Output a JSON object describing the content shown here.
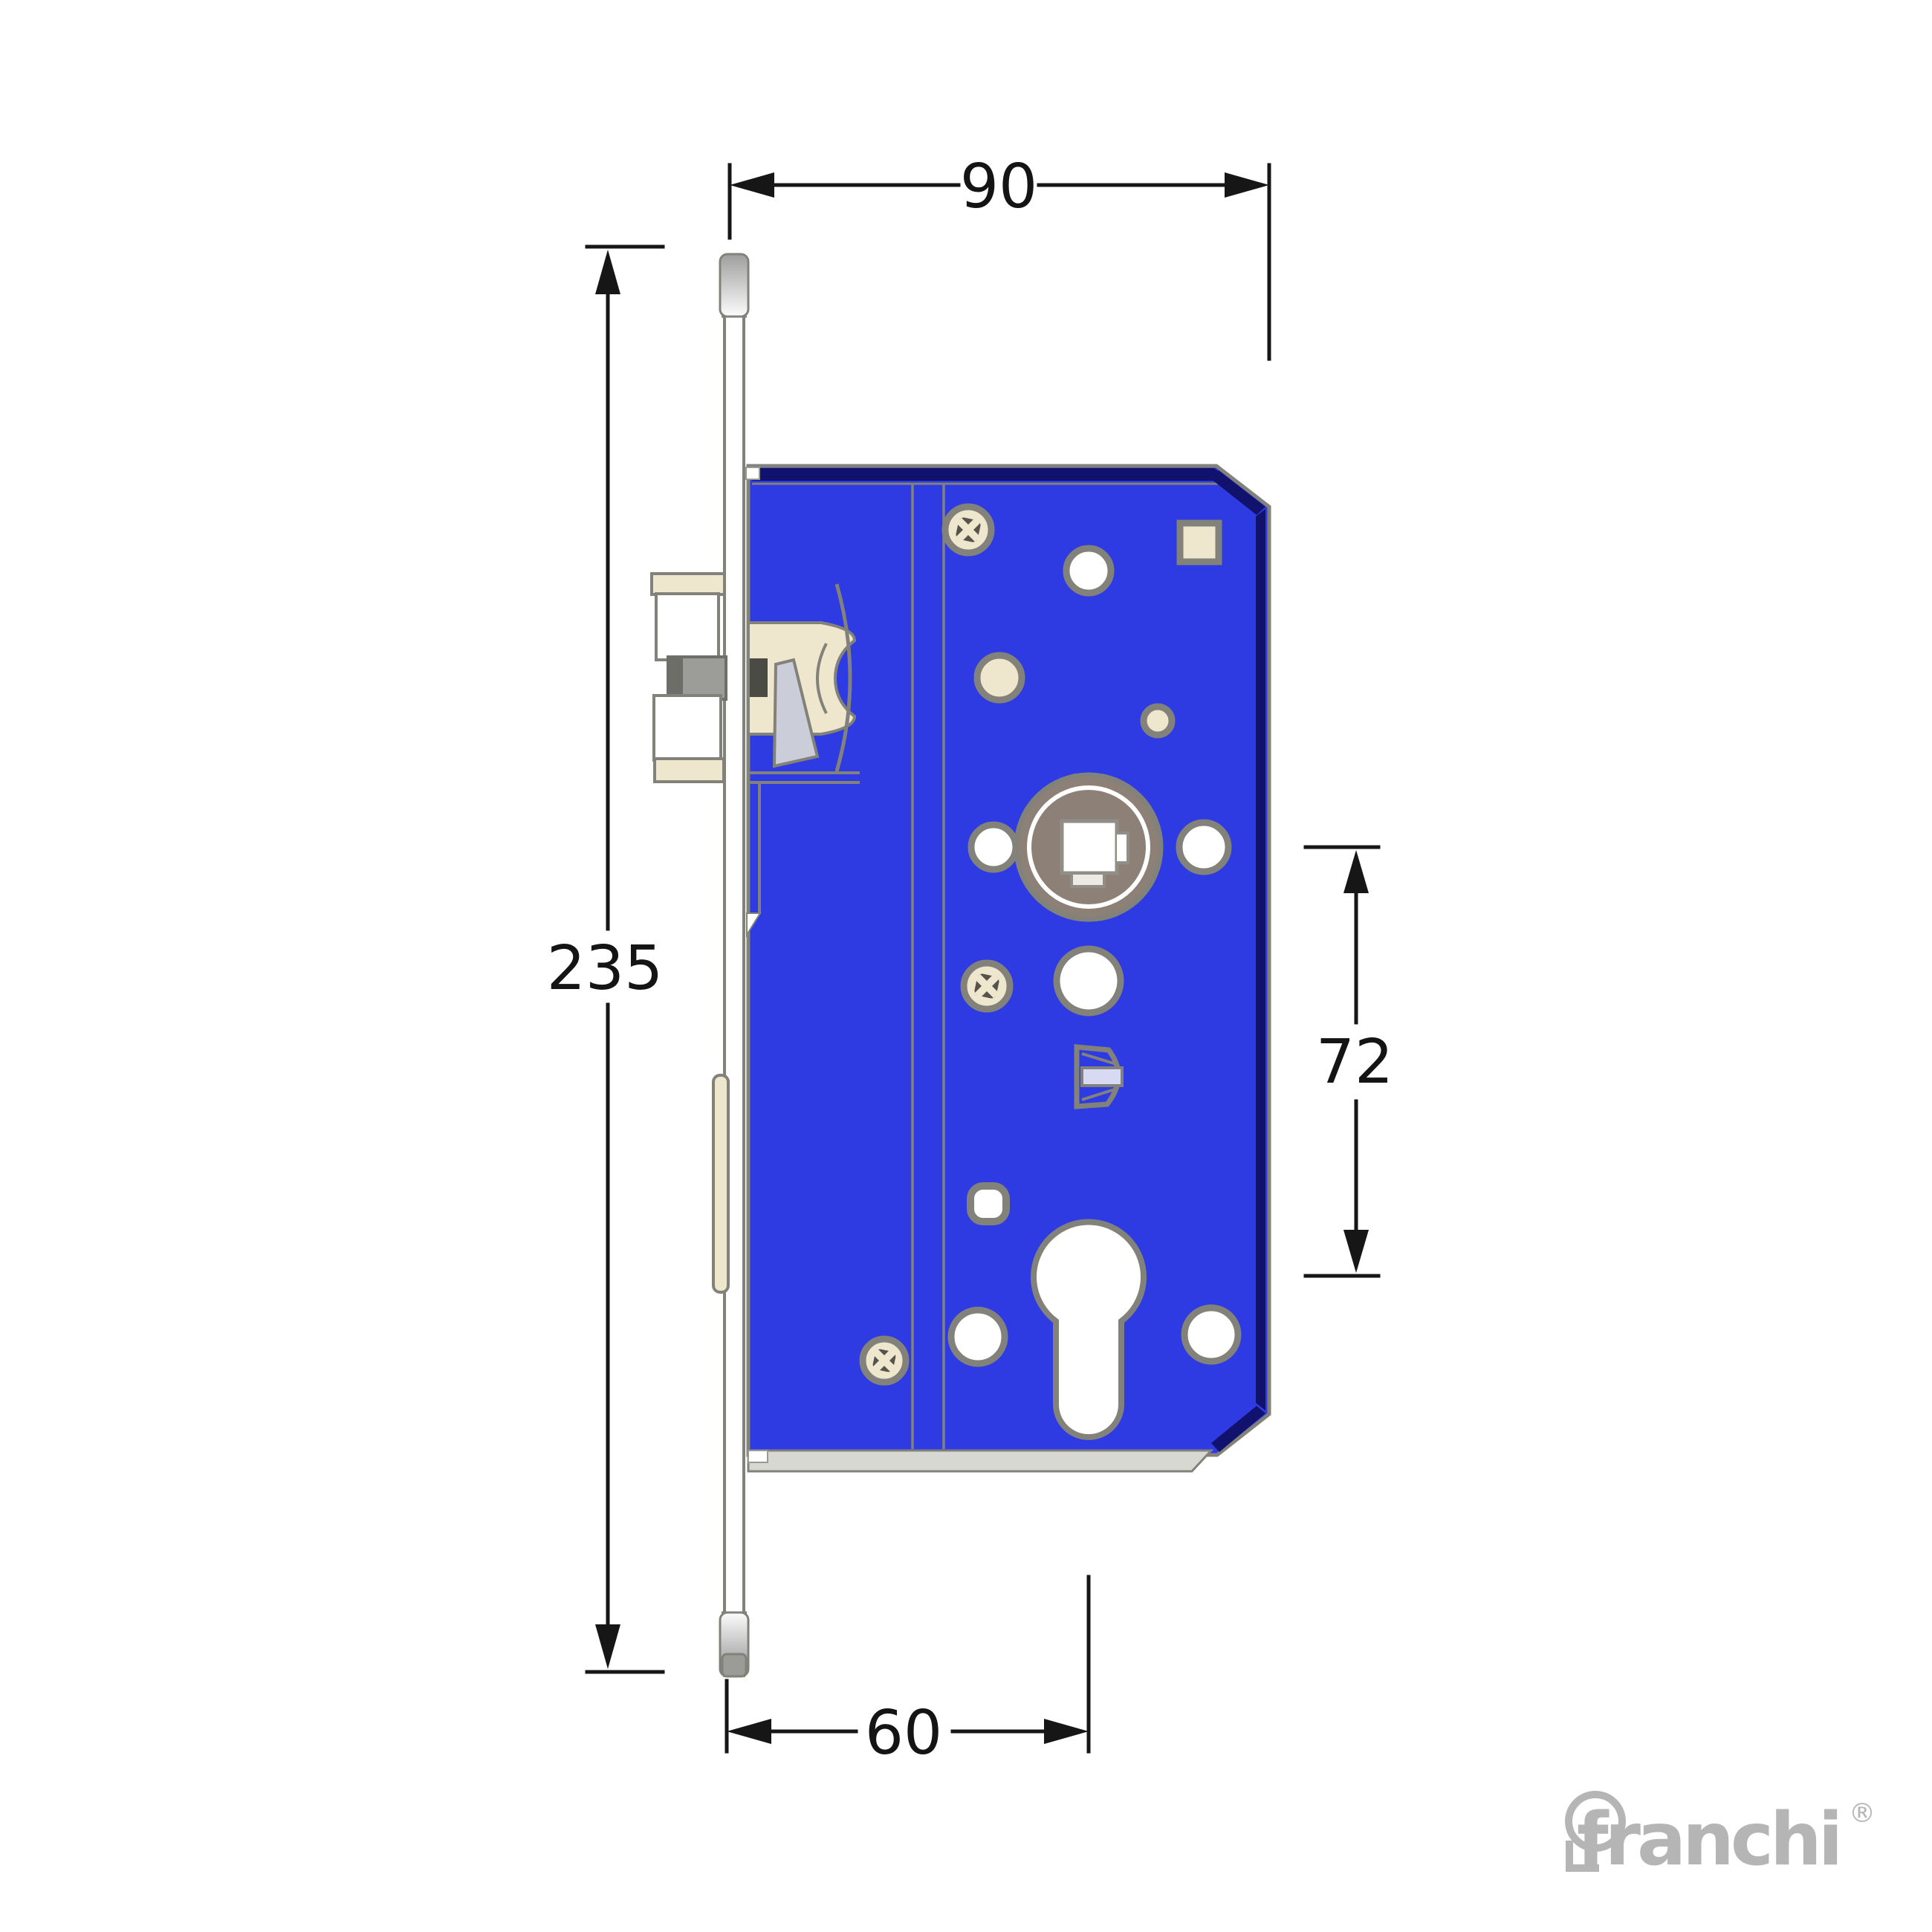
{
  "drawing": {
    "subject": "mortise-lock-case-technical-drawing",
    "dimensions": {
      "total_width": "90",
      "total_height": "235",
      "centres_distance": "72",
      "backset": "60"
    },
    "colors": {
      "case_blue": "#2e3ae2",
      "shadow_navy": "#10126e",
      "outline_gray": "#82827a",
      "hole_cream": "#eee6cd",
      "hub_taupe": "#8d8177",
      "metal_light": "#c9c9c9",
      "dimension_line": "#161616",
      "logo_gray": "#b5b5b5"
    },
    "logo": {
      "brand": "franchi",
      "registered": "®"
    }
  }
}
